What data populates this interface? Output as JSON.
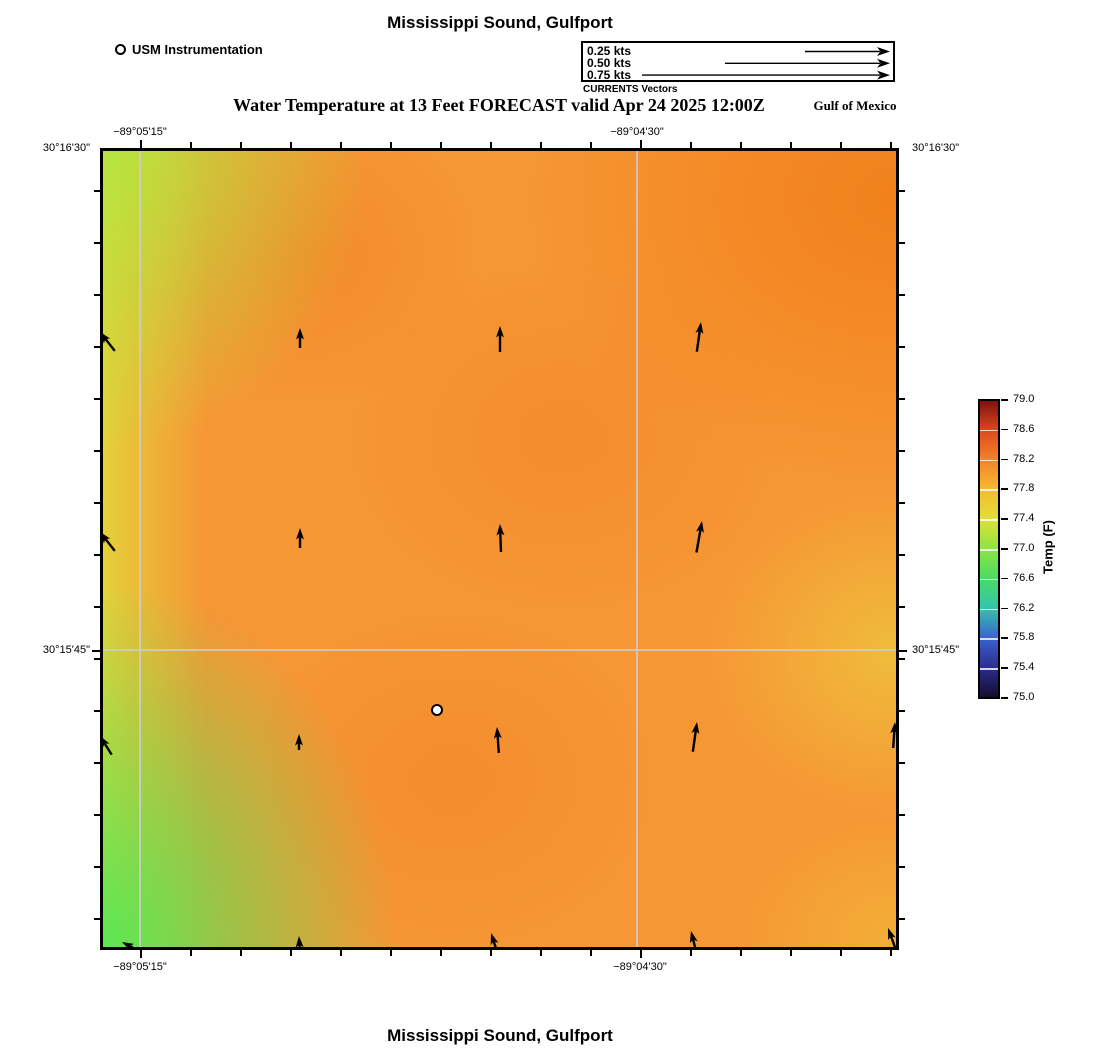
{
  "titles": {
    "top": "Mississippi Sound, Gulfport",
    "subtitle": "Water Temperature at 13 Feet FORECAST valid Apr 24 2025 12:00Z",
    "bottom": "Mississippi Sound, Gulfport",
    "region_label": "Gulf of Mexico"
  },
  "legend": {
    "station_label": "USM Instrumentation",
    "currents_caption": "CURRENTS Vectors",
    "speed_rows": [
      {
        "label": "0.25 kts",
        "line_start": 222
      },
      {
        "label": "0.50 kts",
        "line_start": 142
      },
      {
        "label": "0.75 kts",
        "line_start": 59
      }
    ]
  },
  "axes": {
    "top": [
      {
        "label": "−89°05'15\"",
        "x": 140
      },
      {
        "label": "−89°04'30\"",
        "x": 637
      }
    ],
    "bottom": [
      {
        "label": "−89°05'15\"",
        "x": 140
      },
      {
        "label": "−89°04'30\"",
        "x": 640
      }
    ],
    "left": [
      {
        "label": "30°16'30\"",
        "y": 148
      },
      {
        "label": "30°15'45\"",
        "y": 650
      }
    ],
    "right": [
      {
        "label": "30°16'30\"",
        "y": 148
      },
      {
        "label": "30°15'45\"",
        "y": 650
      }
    ]
  },
  "chart_data": {
    "type": "heatmap",
    "title": "Water Temperature at 13 Feet FORECAST valid Apr 24 2025 12:00Z",
    "region": "Mississippi Sound, Gulfport",
    "forecast_valid": "Apr 24 2025 12:00Z",
    "depth": "13 Feet",
    "lon_range": [
      "−89°05'15\"",
      "−89°04'30\""
    ],
    "lat_range": [
      "30°16'30\"",
      "30°15'45\""
    ],
    "colorbar": {
      "label": "Temp (F)",
      "min": 75.0,
      "max": 79.0,
      "ticks": [
        75.0,
        75.4,
        75.8,
        76.2,
        76.6,
        77.0,
        77.4,
        77.8,
        78.2,
        78.6,
        79.0
      ],
      "stops": [
        {
          "value": 75.0,
          "color": "#160c2f"
        },
        {
          "value": 75.4,
          "color": "#2c2e8f"
        },
        {
          "value": 75.8,
          "color": "#3a63d0"
        },
        {
          "value": 76.2,
          "color": "#35c3ac"
        },
        {
          "value": 76.6,
          "color": "#47dd63"
        },
        {
          "value": 77.0,
          "color": "#8ee441"
        },
        {
          "value": 77.4,
          "color": "#dfe039"
        },
        {
          "value": 77.8,
          "color": "#f5ba32"
        },
        {
          "value": 78.2,
          "color": "#f58329"
        },
        {
          "value": 78.6,
          "color": "#dc4a1f"
        },
        {
          "value": 79.0,
          "color": "#7e120c"
        }
      ]
    },
    "heat_field": {
      "base": "#f69635",
      "left_top": "#b4e53e",
      "left_mid": "#e2d83a",
      "left_bottom": "#55e755",
      "right_top": "#f17e18",
      "right_mid": "#eec33c",
      "right_bottom": "#f0be38",
      "blob": "#ee7f22"
    },
    "gridlines": {
      "x": [
        40,
        537
      ],
      "y": [
        502
      ]
    },
    "station": {
      "name": "USM Instrumentation",
      "x": 337,
      "y": 562
    },
    "vectors": [
      {
        "x": 200,
        "y": 180,
        "len": 20,
        "rot": 0
      },
      {
        "x": 400,
        "y": 178,
        "len": 26,
        "rot": 0
      },
      {
        "x": 601,
        "y": 174,
        "len": 30,
        "rot": 8
      },
      {
        "x": 200,
        "y": 380,
        "len": 20,
        "rot": 0
      },
      {
        "x": 400,
        "y": 376,
        "len": 28,
        "rot": -2
      },
      {
        "x": 602,
        "y": 373,
        "len": 32,
        "rot": 10
      },
      {
        "x": 199,
        "y": 586,
        "len": 16,
        "rot": 0
      },
      {
        "x": 397,
        "y": 579,
        "len": 26,
        "rot": -4
      },
      {
        "x": 597,
        "y": 574,
        "len": 30,
        "rot": 8
      },
      {
        "x": 0,
        "y": 184,
        "len": 24,
        "rot": -38
      },
      {
        "x": 0,
        "y": 384,
        "len": 24,
        "rot": -38
      },
      {
        "x": 0,
        "y": 588,
        "len": 22,
        "rot": -32
      },
      {
        "x": 795,
        "y": 574,
        "len": 26,
        "rot": 4
      },
      {
        "x": 199,
        "y": 788,
        "len": 22,
        "rot": -3
      },
      {
        "x": 391,
        "y": 785,
        "len": 24,
        "rot": -18
      },
      {
        "x": 591,
        "y": 783,
        "len": 26,
        "rot": -14
      },
      {
        "x": 788,
        "y": 780,
        "len": 26,
        "rot": -20
      },
      {
        "x": 22,
        "y": 794,
        "len": 18,
        "rot": -62
      }
    ]
  }
}
